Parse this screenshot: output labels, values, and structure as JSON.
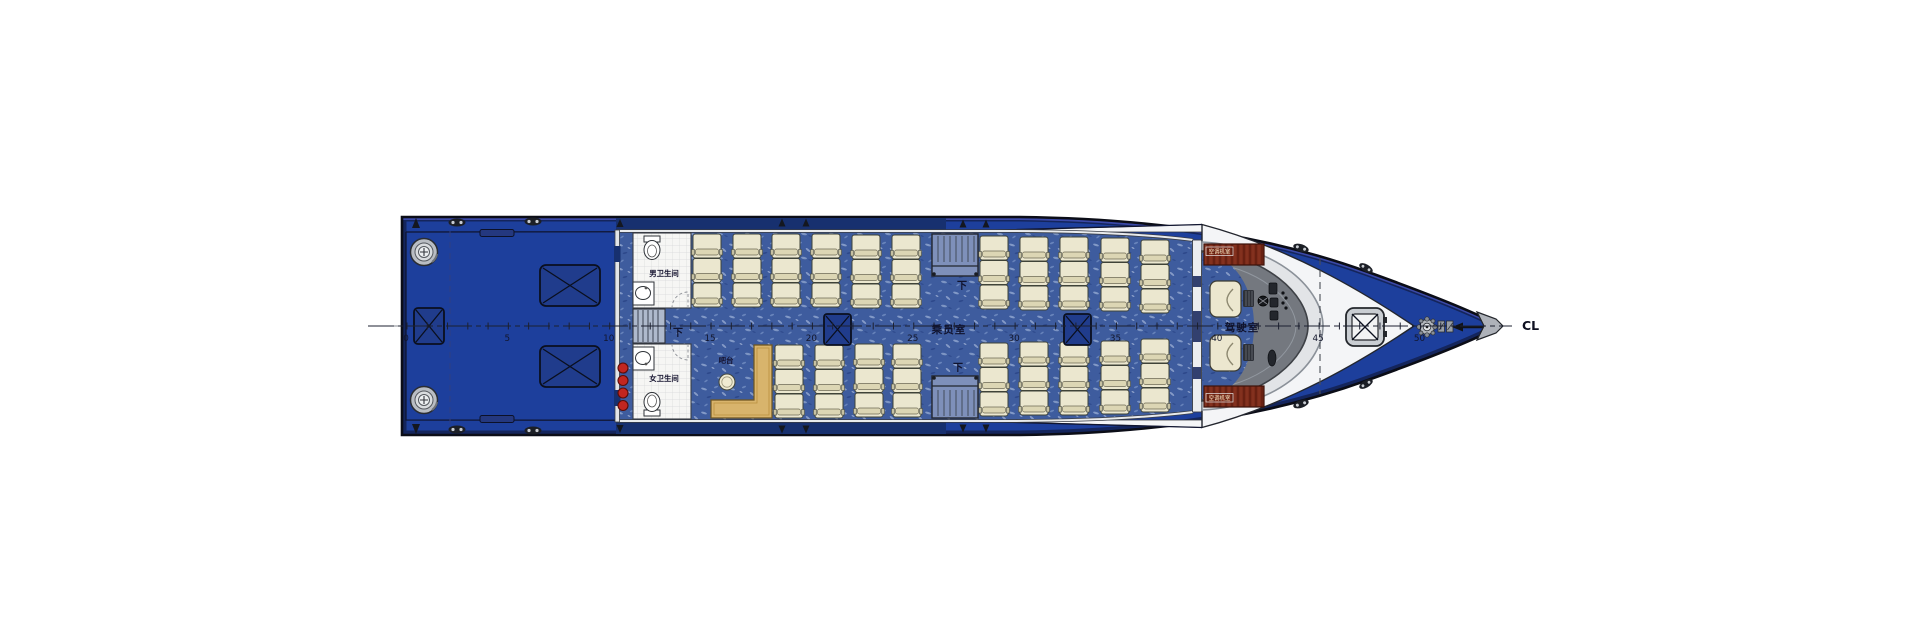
{
  "labels": {
    "mens_toilet": "男卫生间",
    "womens_toilet": "女卫生间",
    "bar_counter": "吧台",
    "stairs_down_aft": "下",
    "stairs_down_upper": "下",
    "stairs_down_lower": "下",
    "passenger_cabin": "乘员室",
    "wheelhouse": "驾驶室",
    "ac_cabinet_upper": "空调机室",
    "ac_cabinet_lower": "空调机室",
    "centerline": "CL"
  },
  "centerline": {
    "numbers": [
      "0",
      "5",
      "10",
      "15",
      "20",
      "25",
      "30",
      "35",
      "40",
      "45",
      "50"
    ],
    "x_start": 407,
    "spacing_px": 20.27,
    "tick_count": 52,
    "y": 326,
    "number_y": 341
  },
  "seats": {
    "seat_width": 28,
    "seat_height": 24,
    "banks": [
      {
        "name": "upper",
        "row_ys": [
          234,
          258.5,
          283
        ],
        "columns": [
          {
            "x": 693,
            "dy": 0
          },
          {
            "x": 733,
            "dy": 0
          },
          {
            "x": 772,
            "dy": 0
          },
          {
            "x": 812,
            "dy": 0
          },
          {
            "x": 852,
            "dy": 1
          },
          {
            "x": 892,
            "dy": 1
          },
          {
            "x": 980,
            "dy": 2
          },
          {
            "x": 1020,
            "dy": 3
          },
          {
            "x": 1060,
            "dy": 3
          },
          {
            "x": 1101,
            "dy": 4
          },
          {
            "x": 1141,
            "dy": 6
          }
        ]
      },
      {
        "name": "lower",
        "row_ys": [
          345,
          369.5,
          394
        ],
        "columns": [
          {
            "x": 775,
            "dy": 0
          },
          {
            "x": 815,
            "dy": 0
          },
          {
            "x": 855,
            "dy": -1
          },
          {
            "x": 893,
            "dy": -1
          },
          {
            "x": 980,
            "dy": -2
          },
          {
            "x": 1020,
            "dy": -3
          },
          {
            "x": 1060,
            "dy": -3
          },
          {
            "x": 1101,
            "dy": -4
          },
          {
            "x": 1141,
            "dy": -6
          }
        ]
      }
    ]
  },
  "colors": {
    "hull_blue": "#1d3f9c",
    "carpet_base": "#3e5c9e",
    "outline_dark": "#0b0d17",
    "seat_cream": "#ebe7cf",
    "bar_tan": "#d8b46c",
    "cabinet_red": "#7b2b1a",
    "red_marker": "#c22620",
    "deck_white": "#f4f5f7",
    "silver": "#c9cdd2"
  }
}
